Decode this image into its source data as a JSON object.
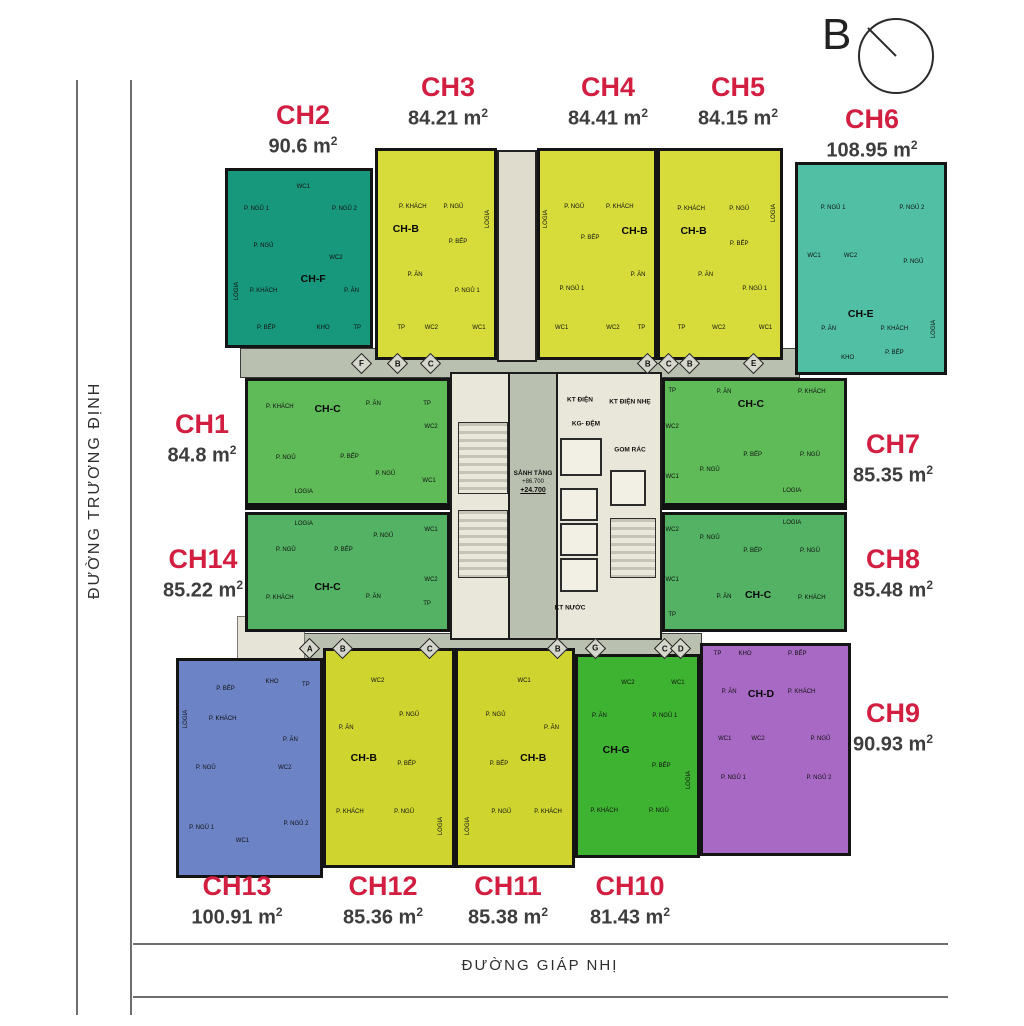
{
  "compass": {
    "letter": "B"
  },
  "streets": {
    "left": "ĐƯỜNG TRƯƠNG ĐỊNH",
    "bottom": "ĐƯỜNG GIÁP NHỊ"
  },
  "core": {
    "lobby_title": "SẢNH TẦNG",
    "level_upper": "+86.700",
    "level_lower": "+24.700",
    "kt_dien": "KT ĐIỆN",
    "kt_dien_nhe": "KT ĐIỆN NHẸ",
    "kg_dem": "KG- ĐỆM",
    "gom_rac": "GOM RÁC",
    "kt_nuoc": "KT NƯỚC"
  },
  "plan": {
    "corridor_markers": {
      "top_y": 356,
      "middle_y": 641,
      "top": [
        {
          "letter": "F",
          "x": 362
        },
        {
          "letter": "B",
          "x": 398
        },
        {
          "letter": "C",
          "x": 431
        },
        {
          "letter": "B",
          "x": 648
        },
        {
          "letter": "C",
          "x": 669
        },
        {
          "letter": "B",
          "x": 690
        },
        {
          "letter": "E",
          "x": 754
        }
      ],
      "middle": [
        {
          "letter": "A",
          "x": 310
        },
        {
          "letter": "B",
          "x": 343
        },
        {
          "letter": "C",
          "x": 430
        },
        {
          "letter": "B",
          "x": 558
        },
        {
          "letter": "G",
          "x": 596
        },
        {
          "letter": "C",
          "x": 665
        },
        {
          "letter": "D",
          "x": 681
        }
      ]
    },
    "units": [
      {
        "id": "CH1",
        "area": "84.8",
        "type": "CH-C",
        "color": "#5fba58",
        "rect": {
          "x": 245,
          "y": 378,
          "w": 205,
          "h": 128
        },
        "label": {
          "x": 202,
          "y": 411
        },
        "type_pos": {
          "x": 40,
          "y": 23
        },
        "rooms": [
          {
            "t": "P. KHÁCH",
            "x": 16,
            "y": 21
          },
          {
            "t": "P. ĂN",
            "x": 63,
            "y": 19
          },
          {
            "t": "TP",
            "x": 90,
            "y": 19
          },
          {
            "t": "WC2",
            "x": 92,
            "y": 38
          },
          {
            "t": "P. NGỦ",
            "x": 19,
            "y": 63
          },
          {
            "t": "P. BẾP",
            "x": 51,
            "y": 62
          },
          {
            "t": "P. NGỦ",
            "x": 69,
            "y": 76
          },
          {
            "t": "WC1",
            "x": 91,
            "y": 82
          },
          {
            "t": "LOGIA",
            "x": 28,
            "y": 91
          }
        ]
      },
      {
        "id": "CH2",
        "area": "90.6",
        "type": "CH-F",
        "color": "#17977b",
        "rect": {
          "x": 225,
          "y": 168,
          "w": 148,
          "h": 180
        },
        "label": {
          "x": 303,
          "y": 102
        },
        "type_pos": {
          "x": 60,
          "y": 62
        },
        "rooms": [
          {
            "t": "P. NGỦ 1",
            "x": 20,
            "y": 22
          },
          {
            "t": "WC1",
            "x": 53,
            "y": 9
          },
          {
            "t": "P. NGỦ 2",
            "x": 82,
            "y": 22
          },
          {
            "t": "P. NGỦ",
            "x": 25,
            "y": 43
          },
          {
            "t": "WC2",
            "x": 76,
            "y": 50
          },
          {
            "t": "LOGIA",
            "x": 6,
            "y": 69,
            "v": 1
          },
          {
            "t": "P. KHÁCH",
            "x": 25,
            "y": 69
          },
          {
            "t": "P. ĂN",
            "x": 87,
            "y": 69
          },
          {
            "t": "P. BẾP",
            "x": 27,
            "y": 90
          },
          {
            "t": "KHO",
            "x": 67,
            "y": 90
          },
          {
            "t": "TP",
            "x": 91,
            "y": 90
          }
        ]
      },
      {
        "id": "CH3",
        "area": "84.21",
        "type": "CH-B",
        "color": "#d7dc3a",
        "rect": {
          "x": 375,
          "y": 148,
          "w": 122,
          "h": 212
        },
        "label": {
          "x": 448,
          "y": 74
        },
        "type_pos": {
          "x": 24,
          "y": 38
        },
        "rooms": [
          {
            "t": "P. KHÁCH",
            "x": 30,
            "y": 27
          },
          {
            "t": "P. NGỦ",
            "x": 65,
            "y": 27
          },
          {
            "t": "LOGIA",
            "x": 95,
            "y": 33,
            "v": 1
          },
          {
            "t": "P. BẾP",
            "x": 69,
            "y": 44
          },
          {
            "t": "P. ĂN",
            "x": 32,
            "y": 60
          },
          {
            "t": "P. NGỦ 1",
            "x": 77,
            "y": 68
          },
          {
            "t": "TP",
            "x": 20,
            "y": 86
          },
          {
            "t": "WC2",
            "x": 46,
            "y": 86
          },
          {
            "t": "WC1",
            "x": 87,
            "y": 86
          }
        ]
      },
      {
        "id": "CH4",
        "area": "84.41",
        "type": "CH-B",
        "color": "#d7dc3a",
        "rect": {
          "x": 537,
          "y": 148,
          "w": 120,
          "h": 212
        },
        "label": {
          "x": 608,
          "y": 74
        },
        "type_pos": {
          "x": 83,
          "y": 39
        },
        "rooms": [
          {
            "t": "LOGIA",
            "x": 5,
            "y": 33,
            "v": 1
          },
          {
            "t": "P. NGỦ",
            "x": 30,
            "y": 27
          },
          {
            "t": "P. KHÁCH",
            "x": 70,
            "y": 27
          },
          {
            "t": "P. BẾP",
            "x": 44,
            "y": 42
          },
          {
            "t": "P. ĂN",
            "x": 86,
            "y": 60
          },
          {
            "t": "P. NGỦ 1",
            "x": 28,
            "y": 67
          },
          {
            "t": "WC1",
            "x": 19,
            "y": 86
          },
          {
            "t": "WC2",
            "x": 64,
            "y": 86
          },
          {
            "t": "TP",
            "x": 89,
            "y": 86
          }
        ]
      },
      {
        "id": "CH5",
        "area": "84.15",
        "type": "CH-B",
        "color": "#d7dc3a",
        "rect": {
          "x": 657,
          "y": 148,
          "w": 126,
          "h": 212
        },
        "label": {
          "x": 738,
          "y": 74
        },
        "type_pos": {
          "x": 28,
          "y": 39
        },
        "rooms": [
          {
            "t": "P. KHÁCH",
            "x": 26,
            "y": 28
          },
          {
            "t": "P. NGỦ",
            "x": 66,
            "y": 28
          },
          {
            "t": "LOGIA",
            "x": 95,
            "y": 30,
            "v": 1
          },
          {
            "t": "P. BẾP",
            "x": 66,
            "y": 45
          },
          {
            "t": "P. ĂN",
            "x": 38,
            "y": 60
          },
          {
            "t": "P. NGỦ 1",
            "x": 79,
            "y": 67
          },
          {
            "t": "TP",
            "x": 18,
            "y": 86
          },
          {
            "t": "WC2",
            "x": 49,
            "y": 86
          },
          {
            "t": "WC1",
            "x": 88,
            "y": 86
          }
        ]
      },
      {
        "id": "CH6",
        "area": "108.95",
        "type": "CH-E",
        "color": "#50bfa3",
        "rect": {
          "x": 795,
          "y": 162,
          "w": 152,
          "h": 213
        },
        "label": {
          "x": 872,
          "y": 106
        },
        "type_pos": {
          "x": 43,
          "y": 72
        },
        "rooms": [
          {
            "t": "P. NGỦ 1",
            "x": 24,
            "y": 21
          },
          {
            "t": "P. NGỦ 2",
            "x": 78,
            "y": 21
          },
          {
            "t": "WC1",
            "x": 11,
            "y": 44
          },
          {
            "t": "WC2",
            "x": 36,
            "y": 44
          },
          {
            "t": "P. NGỦ",
            "x": 79,
            "y": 47
          },
          {
            "t": "P. ĂN",
            "x": 21,
            "y": 79
          },
          {
            "t": "P. KHÁCH",
            "x": 66,
            "y": 79
          },
          {
            "t": "LOGIA",
            "x": 93,
            "y": 79,
            "v": 1
          },
          {
            "t": "KHO",
            "x": 34,
            "y": 93
          },
          {
            "t": "P. BẾP",
            "x": 66,
            "y": 91
          }
        ]
      },
      {
        "id": "CH7",
        "area": "85.35",
        "type": "CH-C",
        "color": "#5fba58",
        "rect": {
          "x": 662,
          "y": 378,
          "w": 185,
          "h": 128
        },
        "label": {
          "x": 893,
          "y": 431
        },
        "type_pos": {
          "x": 48,
          "y": 19
        },
        "rooms": [
          {
            "t": "TP",
            "x": 4,
            "y": 8
          },
          {
            "t": "P. ĂN",
            "x": 33,
            "y": 9
          },
          {
            "t": "P. KHÁCH",
            "x": 82,
            "y": 9
          },
          {
            "t": "WC2",
            "x": 4,
            "y": 38
          },
          {
            "t": "P. NGỦ",
            "x": 25,
            "y": 73
          },
          {
            "t": "P. BẾP",
            "x": 49,
            "y": 61
          },
          {
            "t": "P. NGỦ",
            "x": 81,
            "y": 61
          },
          {
            "t": "WC1",
            "x": 4,
            "y": 79
          },
          {
            "t": "LOGIA",
            "x": 71,
            "y": 90
          }
        ]
      },
      {
        "id": "CH8",
        "area": "85.48",
        "type": "CH-C",
        "color": "#53b264",
        "rect": {
          "x": 662,
          "y": 512,
          "w": 185,
          "h": 120
        },
        "label": {
          "x": 893,
          "y": 546
        },
        "type_pos": {
          "x": 52,
          "y": 70
        },
        "rooms": [
          {
            "t": "LOGIA",
            "x": 71,
            "y": 7
          },
          {
            "t": "WC2",
            "x": 4,
            "y": 13
          },
          {
            "t": "P. NGỦ",
            "x": 25,
            "y": 20
          },
          {
            "t": "P. BẾP",
            "x": 49,
            "y": 32
          },
          {
            "t": "P. NGỦ",
            "x": 81,
            "y": 32
          },
          {
            "t": "WC1",
            "x": 4,
            "y": 57
          },
          {
            "t": "P. ĂN",
            "x": 33,
            "y": 72
          },
          {
            "t": "P. KHÁCH",
            "x": 82,
            "y": 73
          },
          {
            "t": "TP",
            "x": 4,
            "y": 88
          }
        ]
      },
      {
        "id": "CH9",
        "area": "90.93",
        "type": "CH-D",
        "color": "#a769c3",
        "rect": {
          "x": 700,
          "y": 643,
          "w": 151,
          "h": 213
        },
        "label": {
          "x": 893,
          "y": 700
        },
        "type_pos": {
          "x": 40,
          "y": 23
        },
        "rooms": [
          {
            "t": "TP",
            "x": 10,
            "y": 4
          },
          {
            "t": "KHO",
            "x": 29,
            "y": 4
          },
          {
            "t": "P. BẾP",
            "x": 65,
            "y": 4
          },
          {
            "t": "P. ĂN",
            "x": 18,
            "y": 22
          },
          {
            "t": "P. KHÁCH",
            "x": 68,
            "y": 22
          },
          {
            "t": "WC1",
            "x": 15,
            "y": 45
          },
          {
            "t": "WC2",
            "x": 38,
            "y": 45
          },
          {
            "t": "P. NGỦ",
            "x": 81,
            "y": 45
          },
          {
            "t": "P. NGỦ 1",
            "x": 21,
            "y": 64
          },
          {
            "t": "P. NGỦ 2",
            "x": 80,
            "y": 64
          }
        ]
      },
      {
        "id": "CH10",
        "area": "81.43",
        "type": "CH-G",
        "color": "#3eb331",
        "rect": {
          "x": 575,
          "y": 654,
          "w": 125,
          "h": 204
        },
        "label": {
          "x": 630,
          "y": 873
        },
        "type_pos": {
          "x": 32,
          "y": 47
        },
        "rooms": [
          {
            "t": "WC2",
            "x": 42,
            "y": 13
          },
          {
            "t": "WC1",
            "x": 84,
            "y": 13
          },
          {
            "t": "P. ĂN",
            "x": 18,
            "y": 30
          },
          {
            "t": "P. NGỦ 1",
            "x": 73,
            "y": 30
          },
          {
            "t": "P. BẾP",
            "x": 70,
            "y": 55
          },
          {
            "t": "LOGIA",
            "x": 93,
            "y": 62,
            "v": 1
          },
          {
            "t": "P. KHÁCH",
            "x": 22,
            "y": 78
          },
          {
            "t": "P. NGỦ",
            "x": 68,
            "y": 78
          }
        ]
      },
      {
        "id": "CH11",
        "area": "85.38",
        "type": "CH-B",
        "color": "#cfd42e",
        "rect": {
          "x": 455,
          "y": 648,
          "w": 120,
          "h": 220
        },
        "label": {
          "x": 508,
          "y": 873
        },
        "type_pos": {
          "x": 66,
          "y": 50
        },
        "rooms": [
          {
            "t": "WC1",
            "x": 58,
            "y": 14
          },
          {
            "t": "P. NGỦ",
            "x": 33,
            "y": 30
          },
          {
            "t": "P. ĂN",
            "x": 82,
            "y": 36
          },
          {
            "t": "P. BẾP",
            "x": 36,
            "y": 53
          },
          {
            "t": "P. NGỦ",
            "x": 38,
            "y": 75
          },
          {
            "t": "P. KHÁCH",
            "x": 79,
            "y": 75
          },
          {
            "t": "LOGIA",
            "x": 9,
            "y": 82,
            "v": 1
          }
        ]
      },
      {
        "id": "CH12",
        "area": "85.36",
        "type": "CH-B",
        "color": "#cfd42e",
        "rect": {
          "x": 323,
          "y": 648,
          "w": 132,
          "h": 220
        },
        "label": {
          "x": 383,
          "y": 873
        },
        "type_pos": {
          "x": 30,
          "y": 50
        },
        "rooms": [
          {
            "t": "WC2",
            "x": 41,
            "y": 14
          },
          {
            "t": "P. NGỦ",
            "x": 66,
            "y": 30
          },
          {
            "t": "P. ĂN",
            "x": 16,
            "y": 36
          },
          {
            "t": "P. BẾP",
            "x": 64,
            "y": 53
          },
          {
            "t": "P. KHÁCH",
            "x": 19,
            "y": 75
          },
          {
            "t": "P. NGỦ",
            "x": 62,
            "y": 75
          },
          {
            "t": "LOGIA",
            "x": 91,
            "y": 82,
            "v": 1
          }
        ]
      },
      {
        "id": "CH13",
        "area": "100.91",
        "type": null,
        "color": "#6c84c6",
        "rect": {
          "x": 176,
          "y": 658,
          "w": 147,
          "h": 220
        },
        "label": {
          "x": 237,
          "y": 873
        },
        "type_pos": null,
        "rooms": [
          {
            "t": "P. BẾP",
            "x": 33,
            "y": 13
          },
          {
            "t": "KHO",
            "x": 66,
            "y": 10
          },
          {
            "t": "TP",
            "x": 90,
            "y": 11
          },
          {
            "t": "LOGIA",
            "x": 5,
            "y": 27,
            "v": 1
          },
          {
            "t": "P. KHÁCH",
            "x": 31,
            "y": 27
          },
          {
            "t": "P. ĂN",
            "x": 79,
            "y": 37
          },
          {
            "t": "P. NGỦ",
            "x": 19,
            "y": 50
          },
          {
            "t": "WC2",
            "x": 75,
            "y": 50
          },
          {
            "t": "P. NGỦ 1",
            "x": 16,
            "y": 78
          },
          {
            "t": "P. NGỦ 2",
            "x": 83,
            "y": 76
          },
          {
            "t": "WC1",
            "x": 45,
            "y": 84
          }
        ]
      },
      {
        "id": "CH14",
        "area": "85.22",
        "type": "CH-C",
        "color": "#53b264",
        "rect": {
          "x": 245,
          "y": 512,
          "w": 205,
          "h": 120
        },
        "label": {
          "x": 203,
          "y": 546
        },
        "type_pos": {
          "x": 40,
          "y": 63
        },
        "rooms": [
          {
            "t": "LOGIA",
            "x": 28,
            "y": 8
          },
          {
            "t": "P. NGỦ",
            "x": 68,
            "y": 18
          },
          {
            "t": "WC1",
            "x": 92,
            "y": 13
          },
          {
            "t": "P. NGỦ",
            "x": 19,
            "y": 31
          },
          {
            "t": "P. BẾP",
            "x": 48,
            "y": 31
          },
          {
            "t": "WC2",
            "x": 92,
            "y": 57
          },
          {
            "t": "P. KHÁCH",
            "x": 16,
            "y": 73
          },
          {
            "t": "P. ĂN",
            "x": 63,
            "y": 72
          },
          {
            "t": "TP",
            "x": 90,
            "y": 78
          }
        ]
      }
    ]
  }
}
